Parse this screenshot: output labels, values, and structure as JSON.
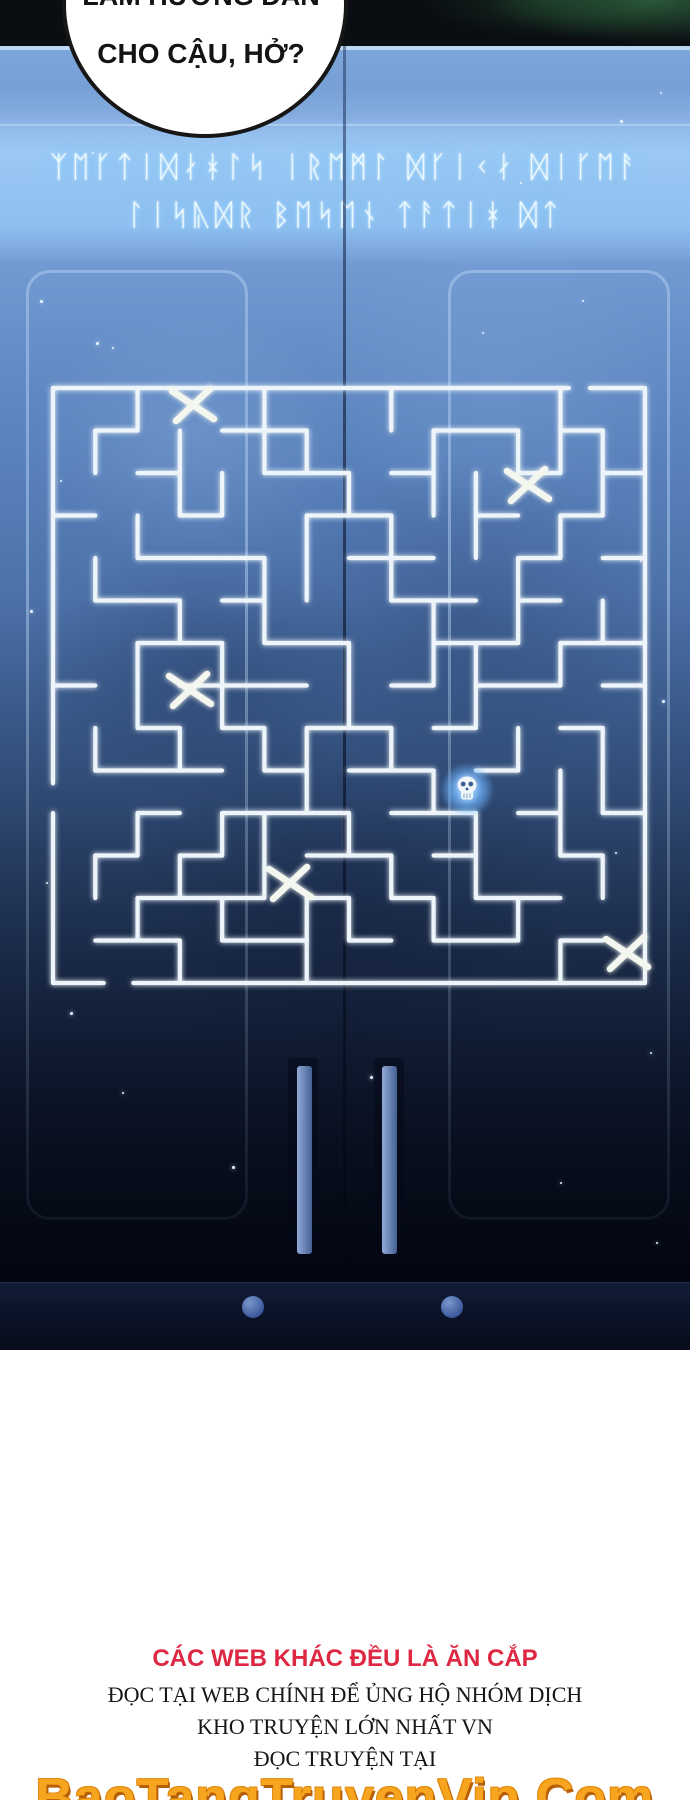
{
  "speech_bubble": {
    "line1_partially_cut": "LÀM HƯỚNG DẪN",
    "line2": "CHO CẬU, HỞ?"
  },
  "door_scene": {
    "runes_line1": "ᛉᛖᚴᛏᛁᛞᛅᚼᛚᛋ ᛁᚱᛖᛗᛚ ᛞᚴᛁᚲᛅ ᛞᛁᚴᛖᚨ",
    "runes_line2": "ᛚᛁᛋᚣᛞᚱ ᛒᛖᛋᛖᚾ ᛏᚨᛏᛁᚼ ᛞᛏ",
    "maze": {
      "x0": 53,
      "y0": 388,
      "cols": 14,
      "rows": 14,
      "cell_w": 42.2857,
      "cell_h": 42.5,
      "line_color": "#edf5fa",
      "walls": [
        [
          0,
          0,
          12.2,
          0
        ],
        [
          12.7,
          0,
          14,
          0
        ],
        [
          14,
          0,
          14,
          14
        ],
        [
          1.9,
          14,
          14,
          14
        ],
        [
          0,
          14,
          1.2,
          14
        ],
        [
          0,
          10,
          0,
          14
        ],
        [
          0,
          0,
          0,
          9.3
        ],
        [
          1,
          1,
          2,
          1
        ],
        [
          4,
          1,
          6,
          1
        ],
        [
          9,
          1,
          11,
          1
        ],
        [
          12,
          1,
          13,
          1
        ],
        [
          2,
          2,
          3,
          2
        ],
        [
          5,
          2,
          7,
          2
        ],
        [
          8,
          2,
          9,
          2
        ],
        [
          11,
          2,
          12,
          2
        ],
        [
          13,
          2,
          14,
          2
        ],
        [
          0,
          3,
          1,
          3
        ],
        [
          3,
          3,
          4,
          3
        ],
        [
          6,
          3,
          8,
          3
        ],
        [
          10,
          3,
          11,
          3
        ],
        [
          12,
          3,
          13,
          3
        ],
        [
          2,
          4,
          5,
          4
        ],
        [
          7,
          4,
          9,
          4
        ],
        [
          11,
          4,
          12,
          4
        ],
        [
          13,
          4,
          14,
          4
        ],
        [
          1,
          5,
          3,
          5
        ],
        [
          4,
          5,
          5,
          5
        ],
        [
          8,
          5,
          10,
          5
        ],
        [
          11,
          5,
          12,
          5
        ],
        [
          2,
          6,
          4,
          6
        ],
        [
          5,
          6,
          7,
          6
        ],
        [
          9,
          6,
          11,
          6
        ],
        [
          12,
          6,
          14,
          6
        ],
        [
          0,
          7,
          1,
          7
        ],
        [
          3,
          7,
          6,
          7
        ],
        [
          8,
          7,
          9,
          7
        ],
        [
          10,
          7,
          12,
          7
        ],
        [
          13,
          7,
          14,
          7
        ],
        [
          2,
          8,
          3,
          8
        ],
        [
          4,
          8,
          5,
          8
        ],
        [
          6,
          8,
          8,
          8
        ],
        [
          9,
          8,
          10,
          8
        ],
        [
          12,
          8,
          13,
          8
        ],
        [
          1,
          9,
          4,
          9
        ],
        [
          5,
          9,
          6,
          9
        ],
        [
          7,
          9,
          9,
          9
        ],
        [
          10,
          9,
          11,
          9
        ],
        [
          2,
          10,
          3,
          10
        ],
        [
          4,
          10,
          7,
          10
        ],
        [
          8,
          10,
          10,
          10
        ],
        [
          11,
          10,
          12,
          10
        ],
        [
          13,
          10,
          14,
          10
        ],
        [
          1,
          11,
          2,
          11
        ],
        [
          3,
          11,
          4,
          11
        ],
        [
          6,
          11,
          8,
          11
        ],
        [
          9,
          11,
          10,
          11
        ],
        [
          12,
          11,
          13,
          11
        ],
        [
          2,
          12,
          5,
          12
        ],
        [
          6,
          12,
          7,
          12
        ],
        [
          8,
          12,
          9,
          12
        ],
        [
          10,
          12,
          12,
          12
        ],
        [
          1,
          13,
          3,
          13
        ],
        [
          4,
          13,
          6,
          13
        ],
        [
          7,
          13,
          8,
          13
        ],
        [
          9,
          13,
          11,
          13
        ],
        [
          12,
          13,
          13,
          13
        ],
        [
          1,
          1,
          1,
          2
        ],
        [
          1,
          4,
          1,
          5
        ],
        [
          1,
          8,
          1,
          9
        ],
        [
          1,
          11,
          1,
          12
        ],
        [
          2,
          0,
          2,
          1
        ],
        [
          2,
          3,
          2,
          4
        ],
        [
          2,
          6,
          2,
          8
        ],
        [
          2,
          10,
          2,
          11
        ],
        [
          2,
          12,
          2,
          13
        ],
        [
          3,
          1,
          3,
          3
        ],
        [
          3,
          5,
          3,
          6
        ],
        [
          3,
          8,
          3,
          9
        ],
        [
          3,
          11,
          3,
          12
        ],
        [
          3,
          13,
          3,
          14
        ],
        [
          4,
          2,
          4,
          3
        ],
        [
          4,
          6,
          4,
          8
        ],
        [
          4,
          10,
          4,
          11
        ],
        [
          4,
          12,
          4,
          13
        ],
        [
          5,
          0,
          5,
          2
        ],
        [
          5,
          4,
          5,
          6
        ],
        [
          5,
          8,
          5,
          9
        ],
        [
          5,
          10,
          5,
          12
        ],
        [
          6,
          1,
          6,
          2
        ],
        [
          6,
          3,
          6,
          5
        ],
        [
          6,
          8,
          6,
          10
        ],
        [
          6,
          12,
          6,
          14
        ],
        [
          7,
          2,
          7,
          3
        ],
        [
          7,
          6,
          7,
          8
        ],
        [
          7,
          10,
          7,
          11
        ],
        [
          7,
          12,
          7,
          13
        ],
        [
          8,
          0,
          8,
          1
        ],
        [
          8,
          3,
          8,
          5
        ],
        [
          8,
          8,
          8,
          9
        ],
        [
          8,
          11,
          8,
          12
        ],
        [
          9,
          1,
          9,
          3
        ],
        [
          9,
          5,
          9,
          7
        ],
        [
          9,
          9,
          9,
          10
        ],
        [
          9,
          12,
          9,
          13
        ],
        [
          10,
          2,
          10,
          4
        ],
        [
          10,
          6,
          10,
          8
        ],
        [
          10,
          10,
          10,
          12
        ],
        [
          11,
          1,
          11,
          2
        ],
        [
          11,
          4,
          11,
          6
        ],
        [
          11,
          8,
          11,
          9
        ],
        [
          11,
          12,
          11,
          13
        ],
        [
          12,
          0,
          12,
          2
        ],
        [
          12,
          3,
          12,
          4
        ],
        [
          12,
          6,
          12,
          7
        ],
        [
          12,
          9,
          12,
          11
        ],
        [
          12,
          13,
          12,
          14
        ],
        [
          13,
          1,
          13,
          3
        ],
        [
          13,
          5,
          13,
          6
        ],
        [
          13,
          8,
          13,
          10
        ],
        [
          13,
          11,
          13,
          12
        ]
      ],
      "x_marks": [
        [
          193,
          405
        ],
        [
          528,
          485
        ],
        [
          190,
          690
        ],
        [
          290,
          883
        ],
        [
          627,
          953
        ]
      ],
      "skull": {
        "x": 467,
        "y": 790
      }
    },
    "sparkles": [
      [
        40,
        300,
        3
      ],
      [
        92,
        152,
        2
      ],
      [
        620,
        120,
        3
      ],
      [
        660,
        92,
        2
      ],
      [
        582,
        300,
        2
      ],
      [
        60,
        480,
        2
      ],
      [
        30,
        610,
        3
      ],
      [
        70,
        1012,
        3
      ],
      [
        122,
        1092,
        2
      ],
      [
        640,
        560,
        2
      ],
      [
        662,
        700,
        3
      ],
      [
        615,
        852,
        2
      ],
      [
        650,
        1052,
        2
      ],
      [
        370,
        1076,
        3
      ],
      [
        482,
        332,
        2
      ],
      [
        300,
        96,
        2
      ],
      [
        172,
        78,
        2
      ],
      [
        520,
        182,
        2
      ],
      [
        600,
        642,
        2
      ],
      [
        46,
        882,
        2
      ],
      [
        232,
        1166,
        3
      ],
      [
        560,
        1182,
        2
      ],
      [
        656,
        1242,
        2
      ],
      [
        96,
        342,
        3
      ],
      [
        112,
        347,
        2
      ]
    ],
    "colors": {
      "door_blue": "#5d87c4",
      "maze_line": "#edf5fa",
      "rune_glow": "#8fd4ff",
      "handle_blue": "#7f97c9",
      "knob_blue": "#3c5a9c"
    }
  },
  "footer": {
    "warning_red": "CÁC WEB KHÁC ĐỀU LÀ ĂN CẮP",
    "line1": "ĐỌC TẠI WEB CHÍNH ĐỂ ỦNG HỘ NHÓM DỊCH",
    "line2": "KHO TRUYỆN LỚN NHẤT VN",
    "line3": "ĐỌC TRUYỆN TẠI",
    "site": "BaoTangTruyenVip.Com",
    "colors": {
      "red": "#dd2743",
      "orange": "#f7a51f"
    }
  }
}
